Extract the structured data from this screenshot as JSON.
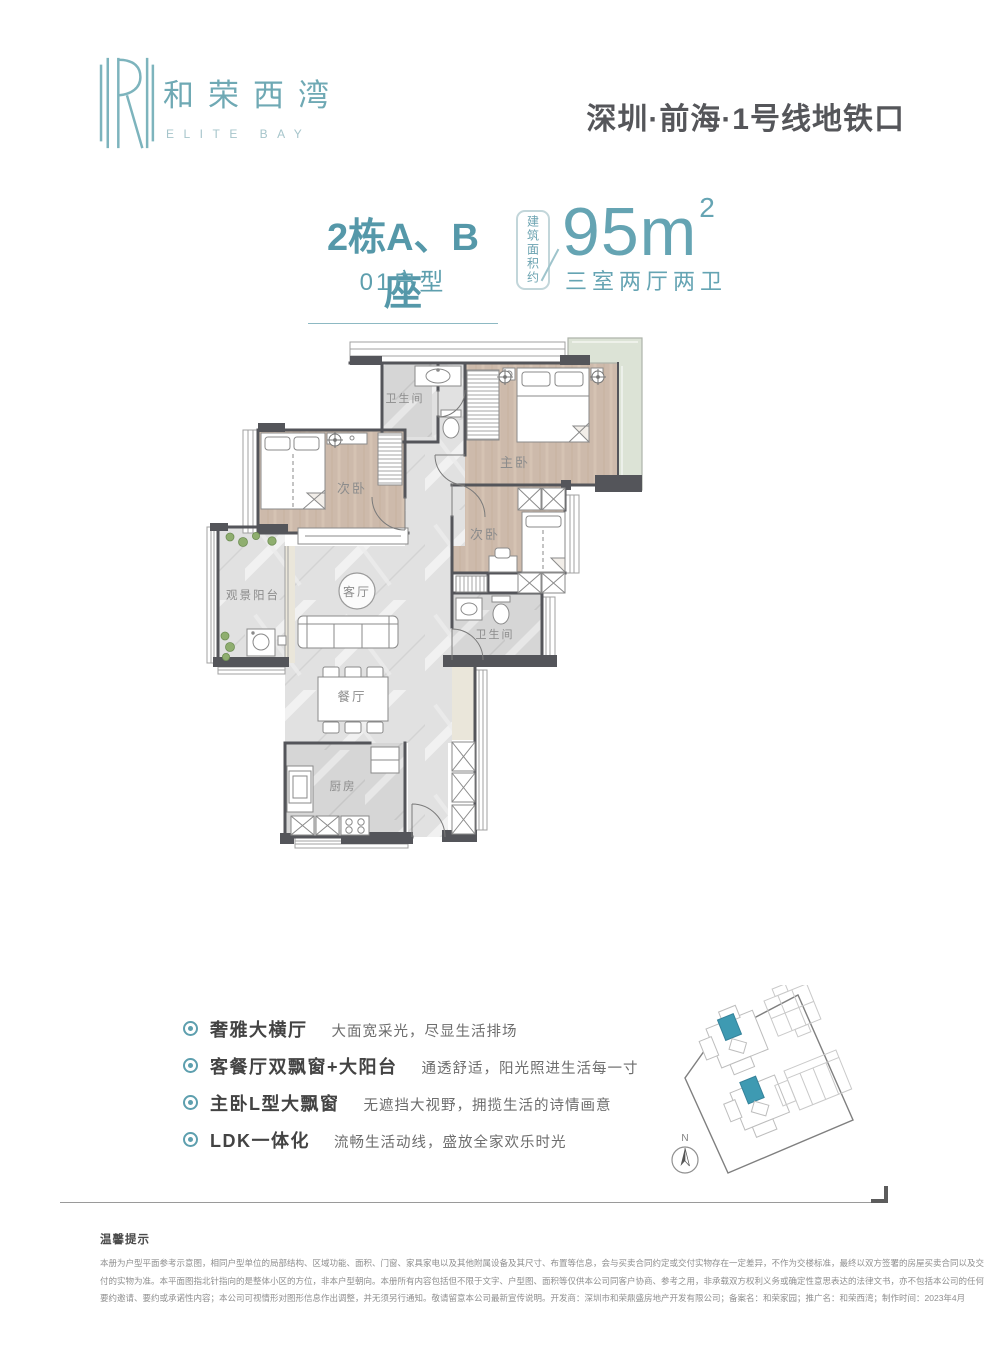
{
  "header": {
    "logo_cn": "和荣西湾",
    "logo_en": "ELITE BAY",
    "location": "深圳·前海·1号线地铁口"
  },
  "title": {
    "block_name": "2栋A、B座",
    "unit_type": "01户型",
    "area_note": "建筑面积约",
    "area_value": "95m",
    "area_superscript": "2",
    "rooms_summary": "三室两厅两卫"
  },
  "floorplan": {
    "labels": {
      "bathroom_top": "卫生间",
      "master_bedroom": "主卧",
      "bedroom_left": "次卧",
      "bedroom_right": "次卧",
      "view_balcony": "观景阳台",
      "living_room": "客厅",
      "dining_room": "餐厅",
      "kitchen": "厨房",
      "bathroom_bottom": "卫生间"
    }
  },
  "features": [
    {
      "title": "奢雅大横厅",
      "desc": "大面宽采光，尽显生活排场"
    },
    {
      "title": "客餐厅双飘窗+大阳台",
      "desc": "通透舒适，阳光照进生活每一寸"
    },
    {
      "title": "主卧L型大飘窗",
      "desc": "无遮挡大视野，拥揽生活的诗情画意"
    },
    {
      "title": "LDK一体化",
      "desc": "流畅生活动线，盛放全家欢乐时光"
    }
  ],
  "siteplan": {
    "compass": "N"
  },
  "disclaimer": {
    "title": "温馨提示",
    "lines": [
      "本册为户型平面参考示意图，相同户型单位的局部结构、区域功能、面积、门窗、家具家电以及其他附属设备及其尺寸、布置等信息，会与买卖合同约定或交付实物存在一定差异，不作为交楼标准，最终以双方签署的房屋买卖合同以及交",
      "付的实物为准。本平面图指北针指向的是整体小区的方位，非本户型朝向。本册所有内容包括但不限于文字、户型图、面积等仅供本公司同客户协商、参考之用，非承载双方权利义务或确定性意思表达的法律文书，亦不包括本公司的任何",
      "要约邀请、要约或承诺性内容；本公司可视情形对图形信息作出调整，并无须另行通知。敬请留意本公司最新宣传说明。开发商：深圳市和荣鼎盛房地产开发有限公司；备案名：和荣家园；推广名：和荣西湾；制作时间：2023年4月"
    ]
  },
  "colors": {
    "teal": "#5d9fae",
    "dark_text": "#55565a",
    "wall": "#54555a"
  }
}
